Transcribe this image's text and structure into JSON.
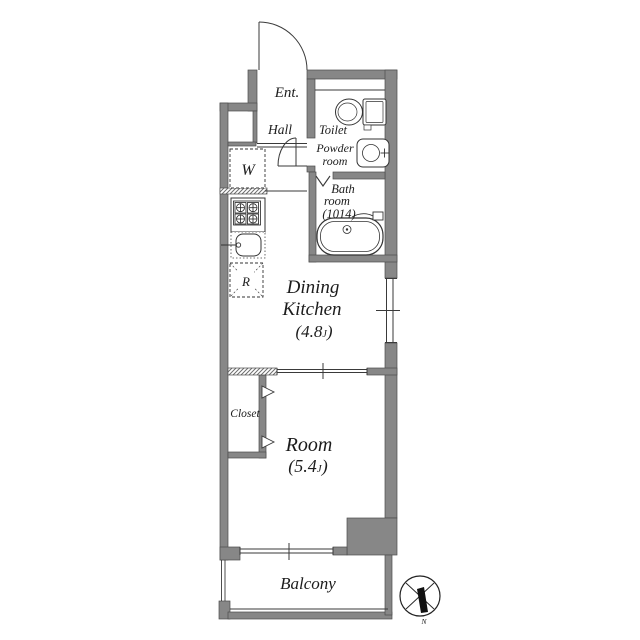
{
  "floorplan": {
    "rooms": {
      "entrance": {
        "label": "Ent."
      },
      "hall": {
        "label": "Hall"
      },
      "toilet": {
        "label": "Toilet"
      },
      "powder_room": {
        "label_line1": "Powder",
        "label_line2": "room"
      },
      "bath_room": {
        "label_line1": "Bath",
        "label_line2": "room",
        "label_line3": "(1014)"
      },
      "washing_machine": {
        "label": "W"
      },
      "refrigerator": {
        "label": "R"
      },
      "dining_kitchen": {
        "label_line1": "Dining",
        "label_line2": "Kitchen",
        "area_prefix": "(4.8",
        "area_unit": "J",
        "area_suffix": ")"
      },
      "closet": {
        "label": "Closet"
      },
      "room": {
        "label": "Room",
        "area_prefix": "(5.4",
        "area_unit": "J",
        "area_suffix": ")"
      },
      "balcony": {
        "label": "Balcony"
      }
    },
    "compass": {
      "north_label": "N"
    },
    "icons": {
      "toilet": "toilet-icon",
      "powder_sink": "washbasin-icon",
      "bathtub": "bathtub-icon",
      "stove": "stove-icon",
      "kitchen_sink": "kitchen-sink-icon",
      "entrance_door": "swing-door-arc-icon",
      "hall_door": "swing-door-arc-icon",
      "bath_door": "folding-door-marker-icon",
      "closet_doors": "door-direction-arrow-icon",
      "compass": "north-compass-icon"
    },
    "colors": {
      "wall": "#878787",
      "wall_edge": "#4d4d4d",
      "line": "#3a3a3a",
      "text": "#1c1c1c",
      "background": "#ffffff"
    }
  }
}
